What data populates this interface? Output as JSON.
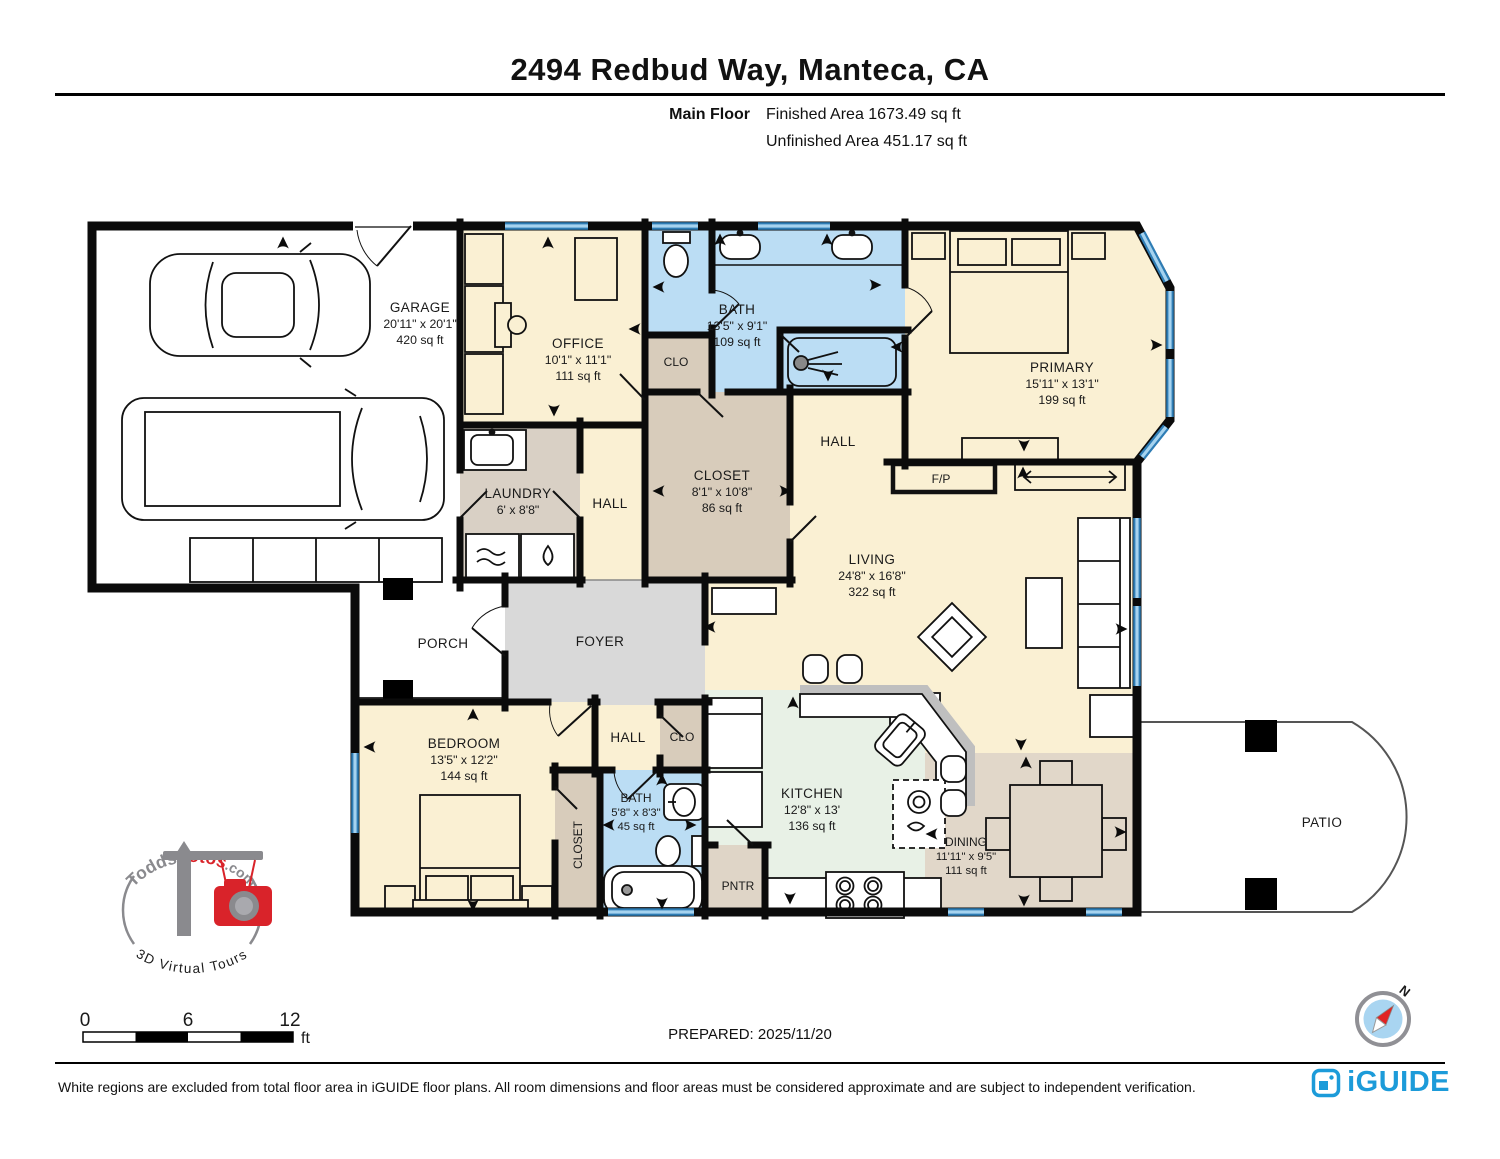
{
  "header": {
    "title": "2494 Redbud Way, Manteca, CA",
    "floor_label": "Main Floor",
    "finished_area": "Finished Area 1673.49 sq ft",
    "unfinished_area": "Unfinished Area 451.17 sq ft"
  },
  "rooms": {
    "garage": {
      "name": "GARAGE",
      "dims": "20'11\" x 20'1\"",
      "area": "420 sq ft"
    },
    "office": {
      "name": "OFFICE",
      "dims": "10'1\" x 11'1\"",
      "area": "111 sq ft"
    },
    "bath1": {
      "name": "BATH",
      "dims": "13'5\" x 9'1\"",
      "area": "109 sq ft"
    },
    "clo1": {
      "name": "CLO"
    },
    "primary": {
      "name": "PRIMARY",
      "dims": "15'11\" x 13'1\"",
      "area": "199 sq ft"
    },
    "hall1": {
      "name": "HALL"
    },
    "fireplace": {
      "name": "F/P"
    },
    "closet1": {
      "name": "CLOSET",
      "dims": "8'1\" x 10'8\"",
      "area": "86 sq ft"
    },
    "laundry": {
      "name": "LAUNDRY",
      "dims": "6' x 8'8\""
    },
    "hall2": {
      "name": "HALL"
    },
    "living": {
      "name": "LIVING",
      "dims": "24'8\" x 16'8\"",
      "area": "322 sq ft"
    },
    "porch": {
      "name": "PORCH"
    },
    "foyer": {
      "name": "FOYER"
    },
    "bedroom": {
      "name": "BEDROOM",
      "dims": "13'5\" x 12'2\"",
      "area": "144 sq ft"
    },
    "hall3": {
      "name": "HALL"
    },
    "clo2": {
      "name": "CLO"
    },
    "closet2": {
      "name": "CLOSET"
    },
    "bath2": {
      "name": "BATH",
      "dims": "5'8\" x 8'3\"",
      "area": "45 sq ft"
    },
    "pantry": {
      "name": "PNTR"
    },
    "kitchen": {
      "name": "KITCHEN",
      "dims": "12'8\" x 13'",
      "area": "136 sq ft"
    },
    "dining": {
      "name": "DINING",
      "dims": "11'11\" x 9'5\"",
      "area": "111 sq ft"
    },
    "patio": {
      "name": "PATIO"
    }
  },
  "scale_bar": {
    "tick0": "0",
    "tick6": "6",
    "tick12": "12",
    "unit": "ft"
  },
  "prepared_label": "PREPARED: 2025/11/20",
  "compass": {
    "north_label": "N"
  },
  "watermark": {
    "brand_gray": "Todds",
    "brand_red": "Fotos",
    "brand_suffix": ".com",
    "tagline": "3D Virtual Tours"
  },
  "footer": {
    "disclaimer": "White regions are excluded from total floor area in iGUIDE floor plans. All room dimensions and floor areas must be considered approximate and are subject to independent verification.",
    "brand": "iGUIDE"
  },
  "colors": {
    "brand_blue": "#1C9BD9",
    "watermark_red": "#D9232A",
    "watermark_gray": "#8A8A8E",
    "window_blue": "#2E7DB5",
    "bath_fill": "#BBDDF4",
    "room_cream": "#FAF0D3",
    "closet_tan": "#D8CCBB",
    "kitchen_mint": "#E8F1E6",
    "foyer_gray": "#D9D9D9"
  }
}
